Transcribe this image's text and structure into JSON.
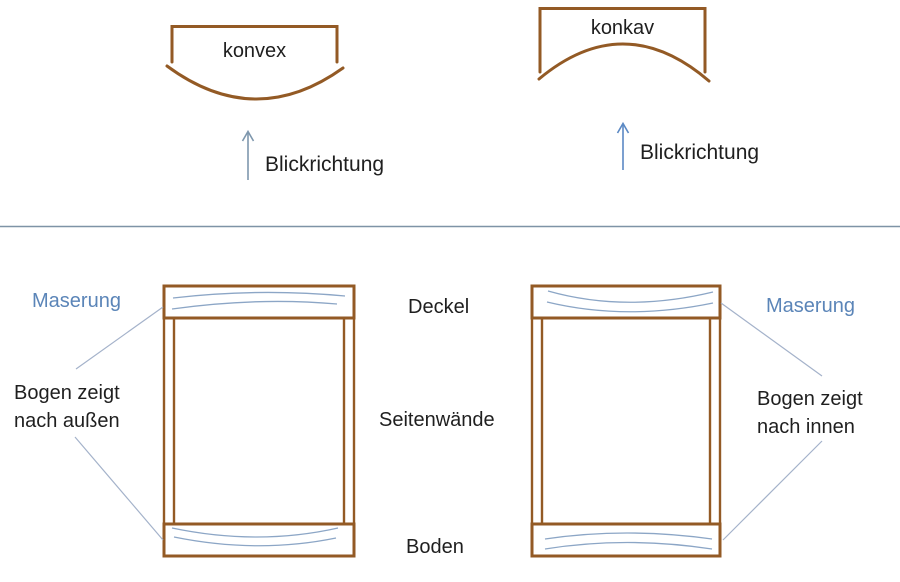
{
  "canvas": {
    "width": 900,
    "height": 582
  },
  "colors": {
    "wood_outline": "#935a25",
    "grain_line": "#8ca6c6",
    "leader_line": "#a4b2ca",
    "divider_line": "#7e93a6",
    "arrow_left": "#7e97ad",
    "arrow_right": "#5b89c4",
    "blue_label_text": "#5b85b8",
    "black_text": "#1f1f1f",
    "background": "#ffffff"
  },
  "top_section": {
    "convex": {
      "label": "konvex",
      "arrow_label": "Blickrichtung"
    },
    "concave": {
      "label": "konkav",
      "arrow_label": "Blickrichtung"
    }
  },
  "bottom_section": {
    "left_box": {
      "grain_label": "Maserung",
      "note_line1": "Bogen zeigt",
      "note_line2": "nach außen"
    },
    "right_box": {
      "grain_label": "Maserung",
      "note_line1": "Bogen zeigt",
      "note_line2": "nach innen"
    },
    "part_labels": {
      "top": "Deckel",
      "sides": "Seitenwände",
      "bottom": "Boden"
    }
  }
}
